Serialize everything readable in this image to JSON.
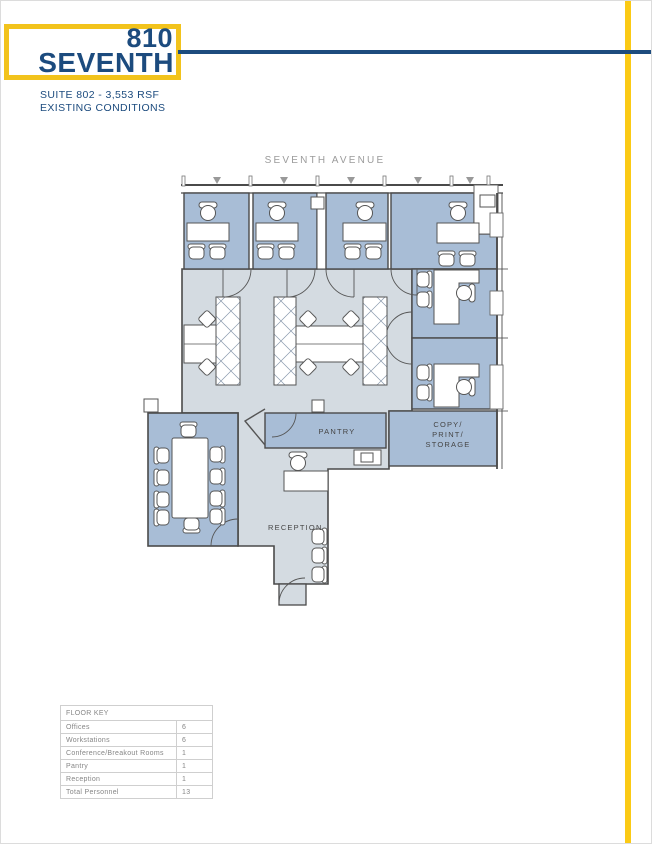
{
  "brand": {
    "number": "810",
    "name": "SEVENTH",
    "colors": {
      "navy": "#1C4B7E",
      "gold": "#FBCA15"
    }
  },
  "subtitle": {
    "line1": "SUITE 802 - 3,553 RSF",
    "line2": "EXISTING CONDITIONS"
  },
  "floor_plan": {
    "street_label": "SEVENTH AVENUE",
    "colors": {
      "room_blue": "#A8BDD6",
      "open_gray": "#D4DBE1",
      "wall": "#4A4A4A"
    },
    "rooms": {
      "pantry": "PANTRY",
      "copy": [
        "COPY/",
        "PRINT/",
        "STORAGE"
      ],
      "reception": "RECEPTION"
    }
  },
  "floor_key": {
    "title": "FLOOR KEY",
    "rows": [
      {
        "label": "Offices",
        "value": "6"
      },
      {
        "label": "Workstations",
        "value": "6"
      },
      {
        "label": "Conference/Breakout Rooms",
        "value": "1"
      },
      {
        "label": "Pantry",
        "value": "1"
      },
      {
        "label": "Reception",
        "value": "1"
      },
      {
        "label": "Total Personnel",
        "value": "13"
      }
    ]
  }
}
